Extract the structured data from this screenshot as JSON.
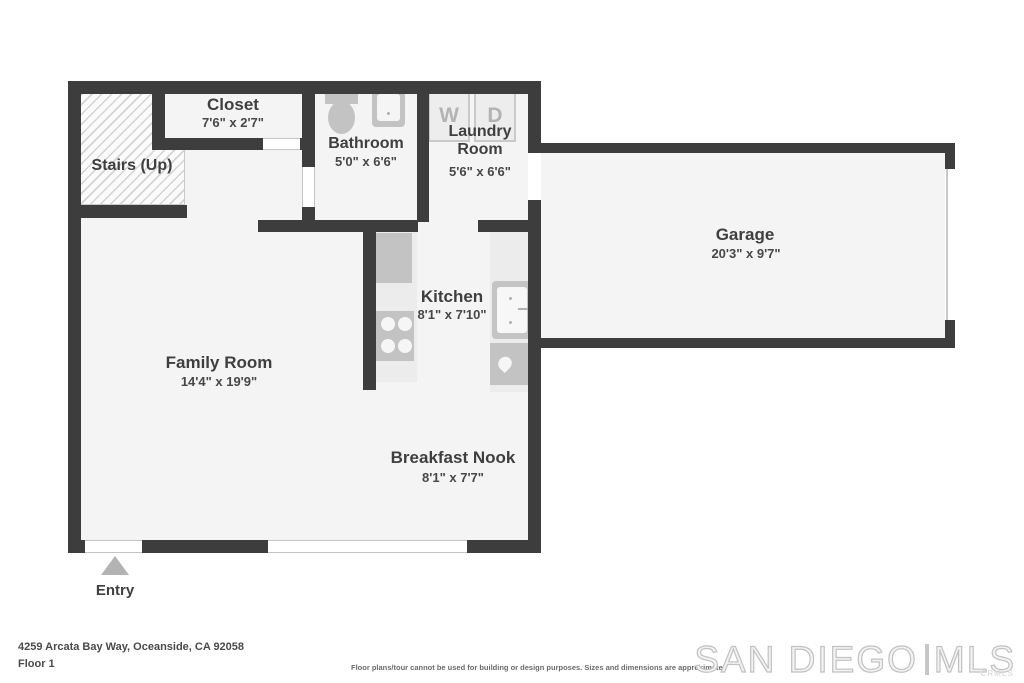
{
  "plan": {
    "rooms": {
      "closet": {
        "name": "Closet",
        "dims": "7'6\" x 2'7\""
      },
      "stairs": {
        "name": "Stairs (Up)"
      },
      "bathroom": {
        "name": "Bathroom",
        "dims": "5'0\" x 6'6\""
      },
      "laundry": {
        "name": "Laundry Room",
        "dims": "5'6\" x 6'6\""
      },
      "garage": {
        "name": "Garage",
        "dims": "20'3\" x 9'7\""
      },
      "kitchen": {
        "name": "Kitchen",
        "dims": "8'1\" x 7'10\""
      },
      "family_room": {
        "name": "Family Room",
        "dims": "14'4\" x 19'9\""
      },
      "breakfast_nook": {
        "name": "Breakfast Nook",
        "dims": "8'1\" x 7'7\""
      }
    },
    "fixtures": {
      "washer": "W",
      "dryer": "D"
    },
    "entry_label": "Entry"
  },
  "footer": {
    "address": "4259 Arcata Bay Way, Oceanside, CA 92058",
    "floor": "Floor 1",
    "disclaimer": "Floor plans/tour cannot be used for building or design purposes. Sizes and dimensions are approximate.",
    "logo": {
      "part1": "SAN DIEGO",
      "part2": "MLS",
      "sub": "CRMLS"
    }
  },
  "colors": {
    "wall": "#3d3d3d",
    "floor": "#f4f4f4",
    "fixture": "#c3c3c3",
    "label": "#3f3f3f"
  }
}
